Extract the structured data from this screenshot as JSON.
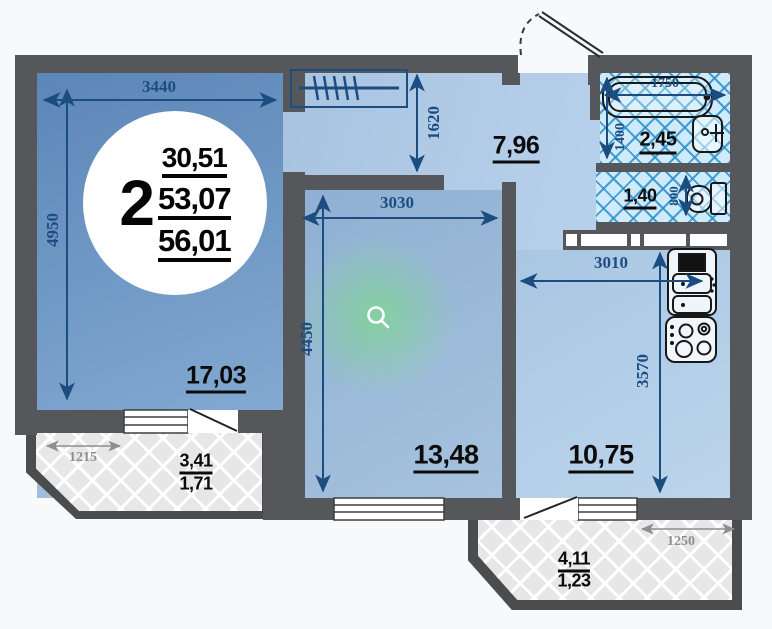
{
  "badge": {
    "room_count": "2",
    "areas": [
      "30,51",
      "53,07",
      "56,01"
    ]
  },
  "labels": {
    "living_area": "17,03",
    "hall_area": "7,96",
    "bedroom_area": "13,48",
    "kitchen_area": "10,75",
    "bath_area": "2,45",
    "wc_area": "1,40",
    "balcony_left_area_top": "3,41",
    "balcony_left_area_bottom": "1,71",
    "balcony_right_area_top": "4,11",
    "balcony_right_area_bottom": "1,23"
  },
  "dimensions_mm": {
    "living_width": "3440",
    "living_depth": "4950",
    "hall_depth": "1620",
    "bedroom_width": "3030",
    "bedroom_depth": "4450",
    "kitchen_width": "3010",
    "kitchen_depth": "3570",
    "bath_width": "1750",
    "bath_depth": "1400",
    "wc_depth": "800",
    "balcony_left_width": "1215",
    "balcony_right_width": "1250"
  },
  "icons": {
    "magnifier": "zoom-indicator"
  },
  "colors": {
    "wall": "#56575a",
    "dim_navy": "#1c4d80",
    "dim_gray": "#8d8e90",
    "tile_line": "#2c91ca",
    "glow_green": "#7dd98c",
    "room_dark_blue": "#5c86b7",
    "room_light_blue": "#b3cde8",
    "balcony_fill": "#e7e7e7"
  }
}
